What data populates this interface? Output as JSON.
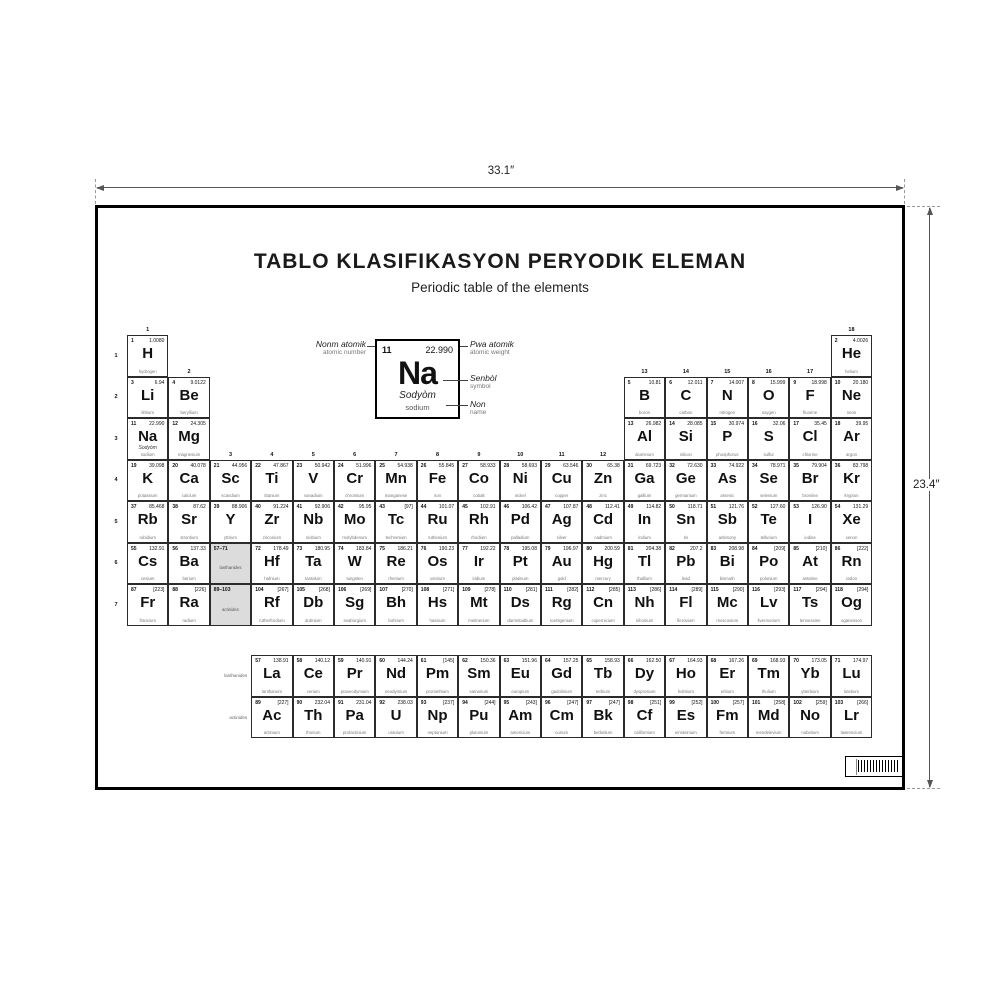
{
  "dimension_labels": {
    "width": "33.1″",
    "height": "23.4″"
  },
  "poster": {
    "title": "TABLO KLASIFIKASYON PERYODIK ELEMAN",
    "subtitle": "Periodic table of the elements",
    "legend": {
      "atomic_number": "11",
      "atomic_weight": "22.990",
      "symbol": "Na",
      "name_creole": "Sodyòm",
      "name_english": "sodium",
      "labels": {
        "atomic_number_creole": "Nonm atomik",
        "atomic_number_english": "atomic number",
        "atomic_weight_creole": "Pwa atomik",
        "atomic_weight_english": "atomic weight",
        "symbol_creole": "Senbòl",
        "symbol_english": "symbol",
        "name_creole": "Non",
        "name_english": "name"
      }
    },
    "group_numbers": [
      "1",
      "2",
      "3",
      "4",
      "5",
      "6",
      "7",
      "8",
      "9",
      "10",
      "11",
      "12",
      "13",
      "14",
      "15",
      "16",
      "17",
      "18"
    ],
    "period_numbers": [
      "1",
      "2",
      "3",
      "4",
      "5",
      "6",
      "7"
    ],
    "fblock_row_labels": [
      "lanthanides",
      "actinides"
    ],
    "placeholders": [
      {
        "range": "57–71",
        "label": "lanthanides"
      },
      {
        "range": "89–103",
        "label": "actinides"
      }
    ],
    "elements": [
      {
        "n": "1",
        "s": "H",
        "w": "1.0080",
        "name": "hydrogen",
        "r": 1,
        "c": 1
      },
      {
        "n": "2",
        "s": "He",
        "w": "4.0026",
        "name": "helium",
        "r": 1,
        "c": 18
      },
      {
        "n": "3",
        "s": "Li",
        "w": "6.94",
        "name": "lithium",
        "r": 2,
        "c": 1
      },
      {
        "n": "4",
        "s": "Be",
        "w": "9.0122",
        "name": "beryllium",
        "r": 2,
        "c": 2
      },
      {
        "n": "5",
        "s": "B",
        "w": "10.81",
        "name": "boron",
        "r": 2,
        "c": 13
      },
      {
        "n": "6",
        "s": "C",
        "w": "12.011",
        "name": "carbon",
        "r": 2,
        "c": 14
      },
      {
        "n": "7",
        "s": "N",
        "w": "14.007",
        "name": "nitrogen",
        "r": 2,
        "c": 15
      },
      {
        "n": "8",
        "s": "O",
        "w": "15.999",
        "name": "oxygen",
        "r": 2,
        "c": 16
      },
      {
        "n": "9",
        "s": "F",
        "w": "18.998",
        "name": "fluorine",
        "r": 2,
        "c": 17
      },
      {
        "n": "10",
        "s": "Ne",
        "w": "20.180",
        "name": "neon",
        "r": 2,
        "c": 18
      },
      {
        "n": "11",
        "s": "Na",
        "w": "22.990",
        "creole": "Sodyòm",
        "name": "sodium",
        "r": 3,
        "c": 1
      },
      {
        "n": "12",
        "s": "Mg",
        "w": "24.305",
        "name": "magnesium",
        "r": 3,
        "c": 2
      },
      {
        "n": "13",
        "s": "Al",
        "w": "26.982",
        "name": "aluminum",
        "r": 3,
        "c": 13
      },
      {
        "n": "14",
        "s": "Si",
        "w": "28.085",
        "name": "silicon",
        "r": 3,
        "c": 14
      },
      {
        "n": "15",
        "s": "P",
        "w": "30.974",
        "name": "phosphorus",
        "r": 3,
        "c": 15
      },
      {
        "n": "16",
        "s": "S",
        "w": "32.06",
        "name": "sulfur",
        "r": 3,
        "c": 16
      },
      {
        "n": "17",
        "s": "Cl",
        "w": "35.45",
        "name": "chlorine",
        "r": 3,
        "c": 17
      },
      {
        "n": "18",
        "s": "Ar",
        "w": "39.95",
        "name": "argon",
        "r": 3,
        "c": 18
      },
      {
        "n": "19",
        "s": "K",
        "w": "39.098",
        "name": "potassium",
        "r": 4,
        "c": 1
      },
      {
        "n": "20",
        "s": "Ca",
        "w": "40.078",
        "name": "calcium",
        "r": 4,
        "c": 2
      },
      {
        "n": "21",
        "s": "Sc",
        "w": "44.956",
        "name": "scandium",
        "r": 4,
        "c": 3
      },
      {
        "n": "22",
        "s": "Ti",
        "w": "47.867",
        "name": "titanium",
        "r": 4,
        "c": 4
      },
      {
        "n": "23",
        "s": "V",
        "w": "50.942",
        "name": "vanadium",
        "r": 4,
        "c": 5
      },
      {
        "n": "24",
        "s": "Cr",
        "w": "51.996",
        "name": "chromium",
        "r": 4,
        "c": 6
      },
      {
        "n": "25",
        "s": "Mn",
        "w": "54.938",
        "name": "manganese",
        "r": 4,
        "c": 7
      },
      {
        "n": "26",
        "s": "Fe",
        "w": "55.845",
        "name": "iron",
        "r": 4,
        "c": 8
      },
      {
        "n": "27",
        "s": "Co",
        "w": "58.933",
        "name": "cobalt",
        "r": 4,
        "c": 9
      },
      {
        "n": "28",
        "s": "Ni",
        "w": "58.693",
        "name": "nickel",
        "r": 4,
        "c": 10
      },
      {
        "n": "29",
        "s": "Cu",
        "w": "63.546",
        "name": "copper",
        "r": 4,
        "c": 11
      },
      {
        "n": "30",
        "s": "Zn",
        "w": "65.38",
        "name": "zinc",
        "r": 4,
        "c": 12
      },
      {
        "n": "31",
        "s": "Ga",
        "w": "69.723",
        "name": "gallium",
        "r": 4,
        "c": 13
      },
      {
        "n": "32",
        "s": "Ge",
        "w": "72.630",
        "name": "germanium",
        "r": 4,
        "c": 14
      },
      {
        "n": "33",
        "s": "As",
        "w": "74.922",
        "name": "arsenic",
        "r": 4,
        "c": 15
      },
      {
        "n": "34",
        "s": "Se",
        "w": "78.971",
        "name": "selenium",
        "r": 4,
        "c": 16
      },
      {
        "n": "35",
        "s": "Br",
        "w": "79.904",
        "name": "bromine",
        "r": 4,
        "c": 17
      },
      {
        "n": "36",
        "s": "Kr",
        "w": "83.798",
        "name": "krypton",
        "r": 4,
        "c": 18
      },
      {
        "n": "37",
        "s": "Rb",
        "w": "85.468",
        "name": "rubidium",
        "r": 5,
        "c": 1
      },
      {
        "n": "38",
        "s": "Sr",
        "w": "87.62",
        "name": "strontium",
        "r": 5,
        "c": 2
      },
      {
        "n": "39",
        "s": "Y",
        "w": "88.906",
        "name": "yttrium",
        "r": 5,
        "c": 3
      },
      {
        "n": "40",
        "s": "Zr",
        "w": "91.224",
        "name": "zirconium",
        "r": 5,
        "c": 4
      },
      {
        "n": "41",
        "s": "Nb",
        "w": "92.906",
        "name": "niobium",
        "r": 5,
        "c": 5
      },
      {
        "n": "42",
        "s": "Mo",
        "w": "95.95",
        "name": "molybdenum",
        "r": 5,
        "c": 6
      },
      {
        "n": "43",
        "s": "Tc",
        "w": "[97]",
        "name": "technetium",
        "r": 5,
        "c": 7
      },
      {
        "n": "44",
        "s": "Ru",
        "w": "101.07",
        "name": "ruthenium",
        "r": 5,
        "c": 8
      },
      {
        "n": "45",
        "s": "Rh",
        "w": "102.91",
        "name": "rhodium",
        "r": 5,
        "c": 9
      },
      {
        "n": "46",
        "s": "Pd",
        "w": "106.42",
        "name": "palladium",
        "r": 5,
        "c": 10
      },
      {
        "n": "47",
        "s": "Ag",
        "w": "107.87",
        "name": "silver",
        "r": 5,
        "c": 11
      },
      {
        "n": "48",
        "s": "Cd",
        "w": "112.41",
        "name": "cadmium",
        "r": 5,
        "c": 12
      },
      {
        "n": "49",
        "s": "In",
        "w": "114.82",
        "name": "indium",
        "r": 5,
        "c": 13
      },
      {
        "n": "50",
        "s": "Sn",
        "w": "118.71",
        "name": "tin",
        "r": 5,
        "c": 14
      },
      {
        "n": "51",
        "s": "Sb",
        "w": "121.76",
        "name": "antimony",
        "r": 5,
        "c": 15
      },
      {
        "n": "52",
        "s": "Te",
        "w": "127.60",
        "name": "tellurium",
        "r": 5,
        "c": 16
      },
      {
        "n": "53",
        "s": "I",
        "w": "126.90",
        "name": "iodine",
        "r": 5,
        "c": 17
      },
      {
        "n": "54",
        "s": "Xe",
        "w": "131.29",
        "name": "xenon",
        "r": 5,
        "c": 18
      },
      {
        "n": "55",
        "s": "Cs",
        "w": "132.91",
        "name": "cesium",
        "r": 6,
        "c": 1
      },
      {
        "n": "56",
        "s": "Ba",
        "w": "137.33",
        "name": "barium",
        "r": 6,
        "c": 2
      },
      {
        "n": "72",
        "s": "Hf",
        "w": "178.49",
        "name": "hafnium",
        "r": 6,
        "c": 4
      },
      {
        "n": "73",
        "s": "Ta",
        "w": "180.95",
        "name": "tantalum",
        "r": 6,
        "c": 5
      },
      {
        "n": "74",
        "s": "W",
        "w": "183.84",
        "name": "tungsten",
        "r": 6,
        "c": 6
      },
      {
        "n": "75",
        "s": "Re",
        "w": "186.21",
        "name": "rhenium",
        "r": 6,
        "c": 7
      },
      {
        "n": "76",
        "s": "Os",
        "w": "190.23",
        "name": "osmium",
        "r": 6,
        "c": 8
      },
      {
        "n": "77",
        "s": "Ir",
        "w": "192.22",
        "name": "iridium",
        "r": 6,
        "c": 9
      },
      {
        "n": "78",
        "s": "Pt",
        "w": "195.08",
        "name": "platinum",
        "r": 6,
        "c": 10
      },
      {
        "n": "79",
        "s": "Au",
        "w": "196.97",
        "name": "gold",
        "r": 6,
        "c": 11
      },
      {
        "n": "80",
        "s": "Hg",
        "w": "200.59",
        "name": "mercury",
        "r": 6,
        "c": 12
      },
      {
        "n": "81",
        "s": "Tl",
        "w": "204.38",
        "name": "thallium",
        "r": 6,
        "c": 13
      },
      {
        "n": "82",
        "s": "Pb",
        "w": "207.2",
        "name": "lead",
        "r": 6,
        "c": 14
      },
      {
        "n": "83",
        "s": "Bi",
        "w": "208.98",
        "name": "bismuth",
        "r": 6,
        "c": 15
      },
      {
        "n": "84",
        "s": "Po",
        "w": "[209]",
        "name": "polonium",
        "r": 6,
        "c": 16
      },
      {
        "n": "85",
        "s": "At",
        "w": "[210]",
        "name": "astatine",
        "r": 6,
        "c": 17
      },
      {
        "n": "86",
        "s": "Rn",
        "w": "[222]",
        "name": "radon",
        "r": 6,
        "c": 18
      },
      {
        "n": "87",
        "s": "Fr",
        "w": "[223]",
        "name": "francium",
        "r": 7,
        "c": 1
      },
      {
        "n": "88",
        "s": "Ra",
        "w": "[226]",
        "name": "radium",
        "r": 7,
        "c": 2
      },
      {
        "n": "104",
        "s": "Rf",
        "w": "[267]",
        "name": "rutherfordium",
        "r": 7,
        "c": 4
      },
      {
        "n": "105",
        "s": "Db",
        "w": "[268]",
        "name": "dubnium",
        "r": 7,
        "c": 5
      },
      {
        "n": "106",
        "s": "Sg",
        "w": "[269]",
        "name": "seaborgium",
        "r": 7,
        "c": 6
      },
      {
        "n": "107",
        "s": "Bh",
        "w": "[270]",
        "name": "bohrium",
        "r": 7,
        "c": 7
      },
      {
        "n": "108",
        "s": "Hs",
        "w": "[271]",
        "name": "hassium",
        "r": 7,
        "c": 8
      },
      {
        "n": "109",
        "s": "Mt",
        "w": "[278]",
        "name": "meitnerium",
        "r": 7,
        "c": 9
      },
      {
        "n": "110",
        "s": "Ds",
        "w": "[281]",
        "name": "darmstadtium",
        "r": 7,
        "c": 10
      },
      {
        "n": "111",
        "s": "Rg",
        "w": "[282]",
        "name": "roentgenium",
        "r": 7,
        "c": 11
      },
      {
        "n": "112",
        "s": "Cn",
        "w": "[285]",
        "name": "copernicium",
        "r": 7,
        "c": 12
      },
      {
        "n": "113",
        "s": "Nh",
        "w": "[286]",
        "name": "nihonium",
        "r": 7,
        "c": 13
      },
      {
        "n": "114",
        "s": "Fl",
        "w": "[289]",
        "name": "flerovium",
        "r": 7,
        "c": 14
      },
      {
        "n": "115",
        "s": "Mc",
        "w": "[290]",
        "name": "moscovium",
        "r": 7,
        "c": 15
      },
      {
        "n": "116",
        "s": "Lv",
        "w": "[293]",
        "name": "livermorium",
        "r": 7,
        "c": 16
      },
      {
        "n": "117",
        "s": "Ts",
        "w": "[294]",
        "name": "tennessine",
        "r": 7,
        "c": 17
      },
      {
        "n": "118",
        "s": "Og",
        "w": "[294]",
        "name": "oganesson",
        "r": 7,
        "c": 18
      },
      {
        "n": "57",
        "s": "La",
        "w": "138.91",
        "name": "lanthanum",
        "r": 8,
        "c": 4
      },
      {
        "n": "58",
        "s": "Ce",
        "w": "140.12",
        "name": "cerium",
        "r": 8,
        "c": 5
      },
      {
        "n": "59",
        "s": "Pr",
        "w": "140.91",
        "name": "praseodymium",
        "r": 8,
        "c": 6
      },
      {
        "n": "60",
        "s": "Nd",
        "w": "144.24",
        "name": "neodymium",
        "r": 8,
        "c": 7
      },
      {
        "n": "61",
        "s": "Pm",
        "w": "[145]",
        "name": "promethium",
        "r": 8,
        "c": 8
      },
      {
        "n": "62",
        "s": "Sm",
        "w": "150.36",
        "name": "samarium",
        "r": 8,
        "c": 9
      },
      {
        "n": "63",
        "s": "Eu",
        "w": "151.96",
        "name": "europium",
        "r": 8,
        "c": 10
      },
      {
        "n": "64",
        "s": "Gd",
        "w": "157.25",
        "name": "gadolinium",
        "r": 8,
        "c": 11
      },
      {
        "n": "65",
        "s": "Tb",
        "w": "158.93",
        "name": "terbium",
        "r": 8,
        "c": 12
      },
      {
        "n": "66",
        "s": "Dy",
        "w": "162.50",
        "name": "dysprosium",
        "r": 8,
        "c": 13
      },
      {
        "n": "67",
        "s": "Ho",
        "w": "164.93",
        "name": "holmium",
        "r": 8,
        "c": 14
      },
      {
        "n": "68",
        "s": "Er",
        "w": "167.26",
        "name": "erbium",
        "r": 8,
        "c": 15
      },
      {
        "n": "69",
        "s": "Tm",
        "w": "168.93",
        "name": "thulium",
        "r": 8,
        "c": 16
      },
      {
        "n": "70",
        "s": "Yb",
        "w": "173.05",
        "name": "ytterbium",
        "r": 8,
        "c": 17
      },
      {
        "n": "71",
        "s": "Lu",
        "w": "174.97",
        "name": "lutetium",
        "r": 8,
        "c": 18
      },
      {
        "n": "89",
        "s": "Ac",
        "w": "[227]",
        "name": "actinium",
        "r": 9,
        "c": 4
      },
      {
        "n": "90",
        "s": "Th",
        "w": "232.04",
        "name": "thorium",
        "r": 9,
        "c": 5
      },
      {
        "n": "91",
        "s": "Pa",
        "w": "231.04",
        "name": "protactinium",
        "r": 9,
        "c": 6
      },
      {
        "n": "92",
        "s": "U",
        "w": "238.03",
        "name": "uranium",
        "r": 9,
        "c": 7
      },
      {
        "n": "93",
        "s": "Np",
        "w": "[237]",
        "name": "neptunium",
        "r": 9,
        "c": 8
      },
      {
        "n": "94",
        "s": "Pu",
        "w": "[244]",
        "name": "plutonium",
        "r": 9,
        "c": 9
      },
      {
        "n": "95",
        "s": "Am",
        "w": "[243]",
        "name": "americium",
        "r": 9,
        "c": 10
      },
      {
        "n": "96",
        "s": "Cm",
        "w": "[247]",
        "name": "curium",
        "r": 9,
        "c": 11
      },
      {
        "n": "97",
        "s": "Bk",
        "w": "[247]",
        "name": "berkelium",
        "r": 9,
        "c": 12
      },
      {
        "n": "98",
        "s": "Cf",
        "w": "[251]",
        "name": "californium",
        "r": 9,
        "c": 13
      },
      {
        "n": "99",
        "s": "Es",
        "w": "[252]",
        "name": "einsteinium",
        "r": 9,
        "c": 14
      },
      {
        "n": "100",
        "s": "Fm",
        "w": "[257]",
        "name": "fermium",
        "r": 9,
        "c": 15
      },
      {
        "n": "101",
        "s": "Md",
        "w": "[258]",
        "name": "mendelevium",
        "r": 9,
        "c": 16
      },
      {
        "n": "102",
        "s": "No",
        "w": "[259]",
        "name": "nobelium",
        "r": 9,
        "c": 17
      },
      {
        "n": "103",
        "s": "Lr",
        "w": "[266]",
        "name": "lawrencium",
        "r": 9,
        "c": 18
      }
    ]
  }
}
